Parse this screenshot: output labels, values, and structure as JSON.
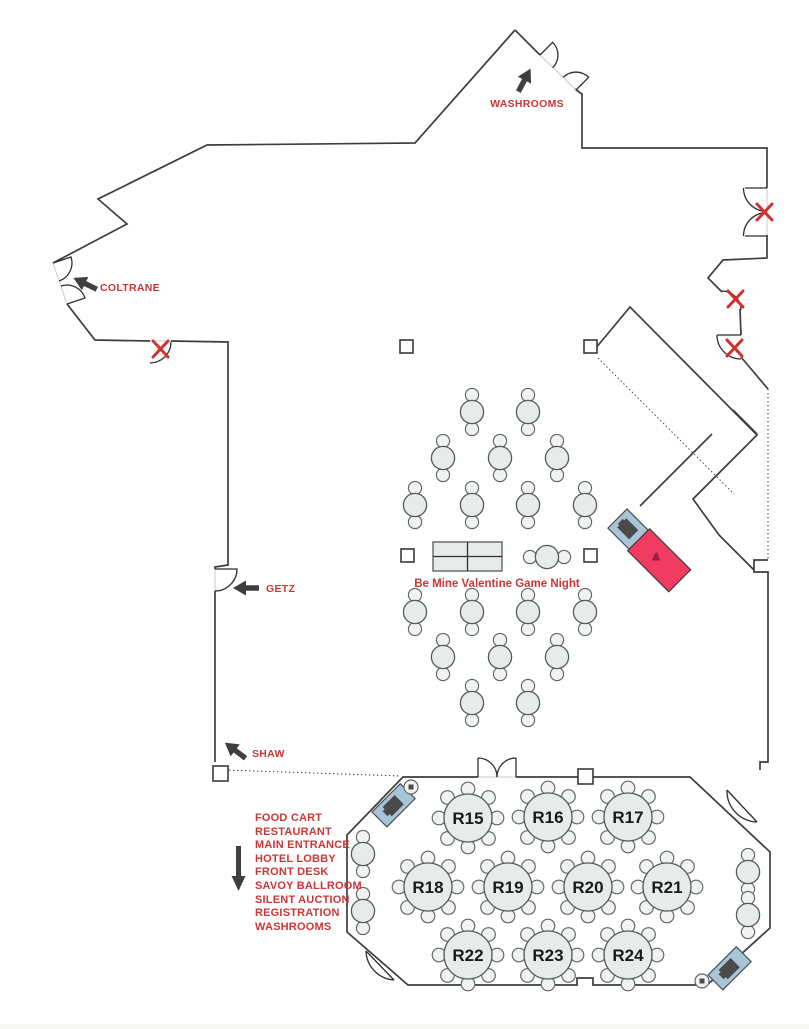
{
  "colors": {
    "wall": "#3d3d3d",
    "red": "#c93737",
    "x": "#d33030",
    "arrow": "#3f3f3f",
    "furn-fill": "#e7eceb",
    "furn-stroke": "#545a58",
    "station-blue": "#a9c4d4",
    "station-pink": "#f23b61"
  },
  "labels": {
    "washrooms": "WASHROOMS",
    "coltrane": "COLTRANE",
    "getz": "GETZ",
    "shaw": "SHAW",
    "event_title": "Be Mine Valentine Game Night"
  },
  "legend": {
    "items": [
      "FOOD CART",
      "RESTAURANT",
      "MAIN ENTRANCE",
      "HOTEL LOBBY",
      "FRONT DESK",
      "SAVOY BALLROOM",
      "SILENT AUCTION",
      "REGISTRATION",
      "WASHROOMS"
    ]
  },
  "ballroom": {
    "tables": [
      {
        "label": "R15"
      },
      {
        "label": "R16"
      },
      {
        "label": "R17"
      },
      {
        "label": "R18"
      },
      {
        "label": "R19"
      },
      {
        "label": "R20"
      },
      {
        "label": "R21"
      },
      {
        "label": "R22"
      },
      {
        "label": "R23"
      },
      {
        "label": "R24"
      }
    ]
  }
}
